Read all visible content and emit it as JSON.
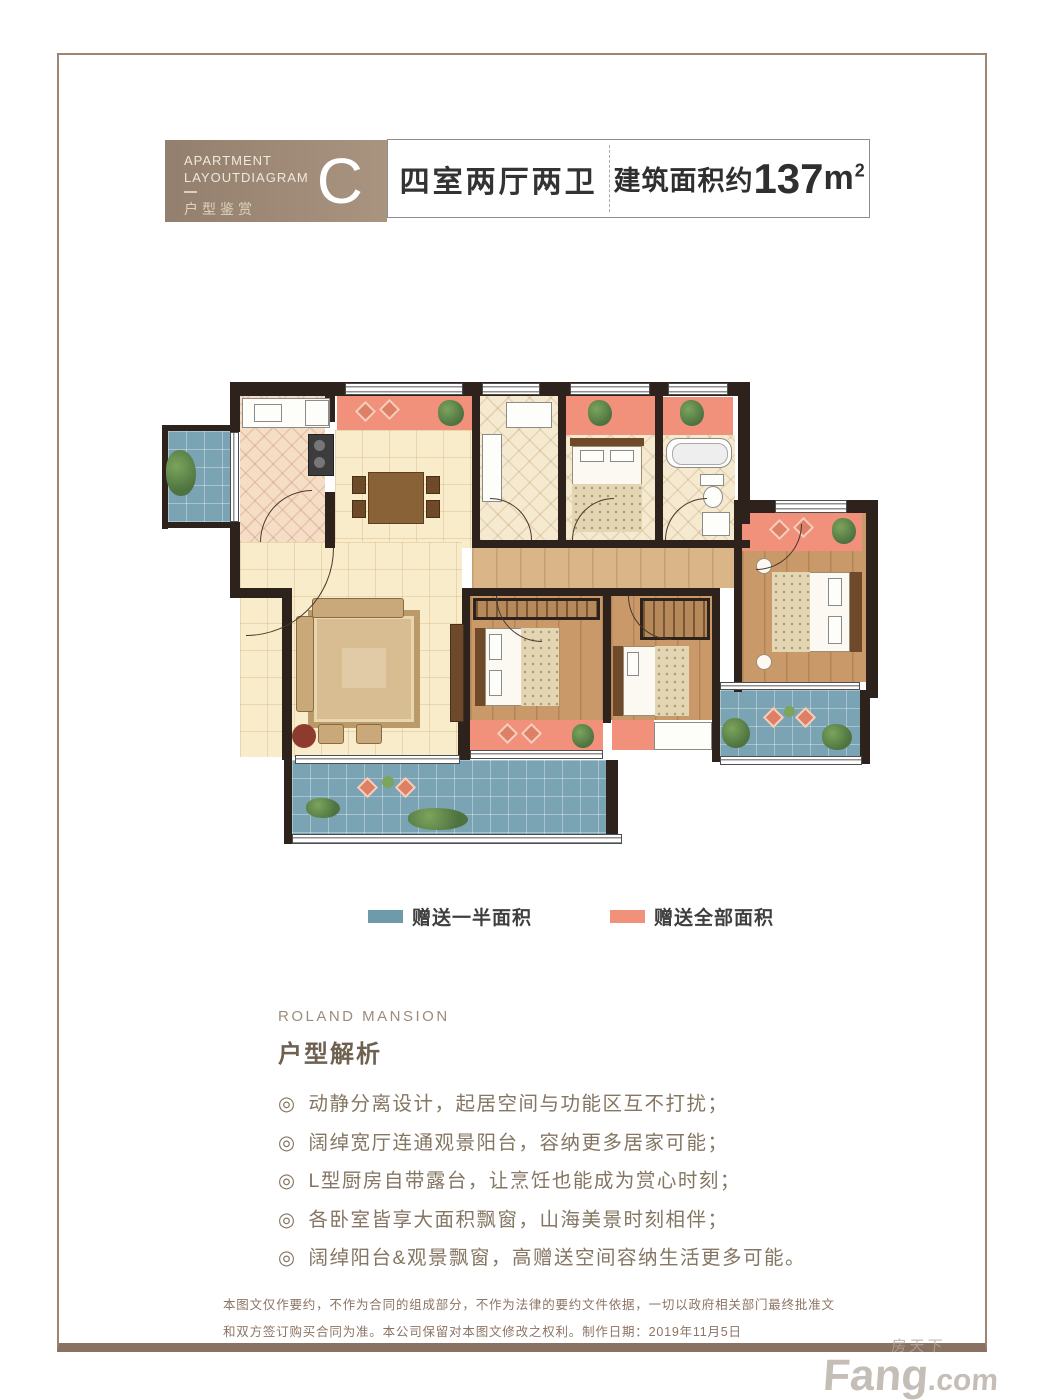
{
  "header": {
    "eyebrow_line1": "APARTMENT",
    "eyebrow_line2": "LAYOUTDIAGRAM",
    "eyebrow_cn": "户型鉴赏",
    "unit_letter": "C",
    "layout_label": "四室两厅两卫",
    "area_prefix": "建筑面积约",
    "area_value": "137",
    "area_unit": "m",
    "area_sup": "2"
  },
  "legend": {
    "half": {
      "label": "赠送一半面积",
      "color": "#6f9aac"
    },
    "full": {
      "label": "赠送全部面积",
      "color": "#f2917a"
    }
  },
  "analysis": {
    "brand": "ROLAND MANSION",
    "title": "户型解析",
    "marker": "◎",
    "bullets": [
      "动静分离设计，起居空间与功能区互不打扰；",
      "阔绰宽厅连通观景阳台，容纳更多居家可能；",
      "L型厨房自带露台，让烹饪也能成为赏心时刻；",
      "各卧室皆享大面积飘窗，山海美景时刻相伴；",
      "阔绰阳台&观景飘窗，高赠送空间容纳生活更多可能。"
    ]
  },
  "footer": {
    "disclaimer": "本图文仅作要约，不作为合同的组成部分，不作为法律的要约文件依据，一切以政府相关部门最终批准文和双方签订购买合同为准。本公司保留对本图文修改之权利。制作日期：2019年11月5日"
  },
  "watermark": {
    "cn": "房天下",
    "en": "Fang",
    "com": ".com"
  }
}
